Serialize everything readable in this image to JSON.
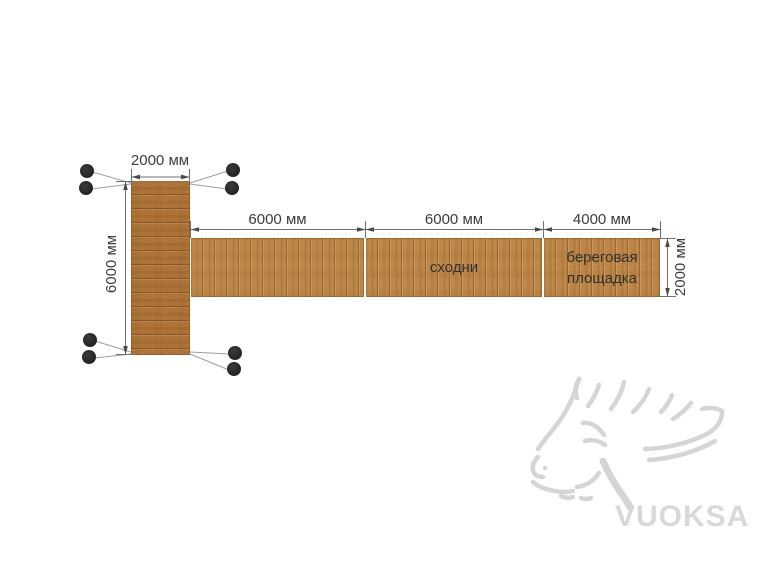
{
  "diagram": {
    "dimensions": {
      "platform_width": "2000 мм",
      "platform_length": "6000 мм",
      "walkway_segment_1": "6000 мм",
      "walkway_segment_2": "6000 мм",
      "shore_segment": "4000 мм",
      "walkway_width": "2000 мм"
    },
    "labels": {
      "gangway": "сходни",
      "shore_platform_line1": "береговая",
      "shore_platform_line2": "площадка"
    },
    "watermark": {
      "brand": "VUOKSA",
      "icon": "moose-head"
    },
    "colors": {
      "background": "#ffffff",
      "deck_platform": "#ae7339",
      "deck_walkway": "#bd8749",
      "dimension_line": "#707070",
      "leader_line": "#9f9f9f",
      "dimension_text": "#3c3c3c",
      "float_marker": "#262626",
      "watermark_gray": "#d6d6d6"
    }
  }
}
